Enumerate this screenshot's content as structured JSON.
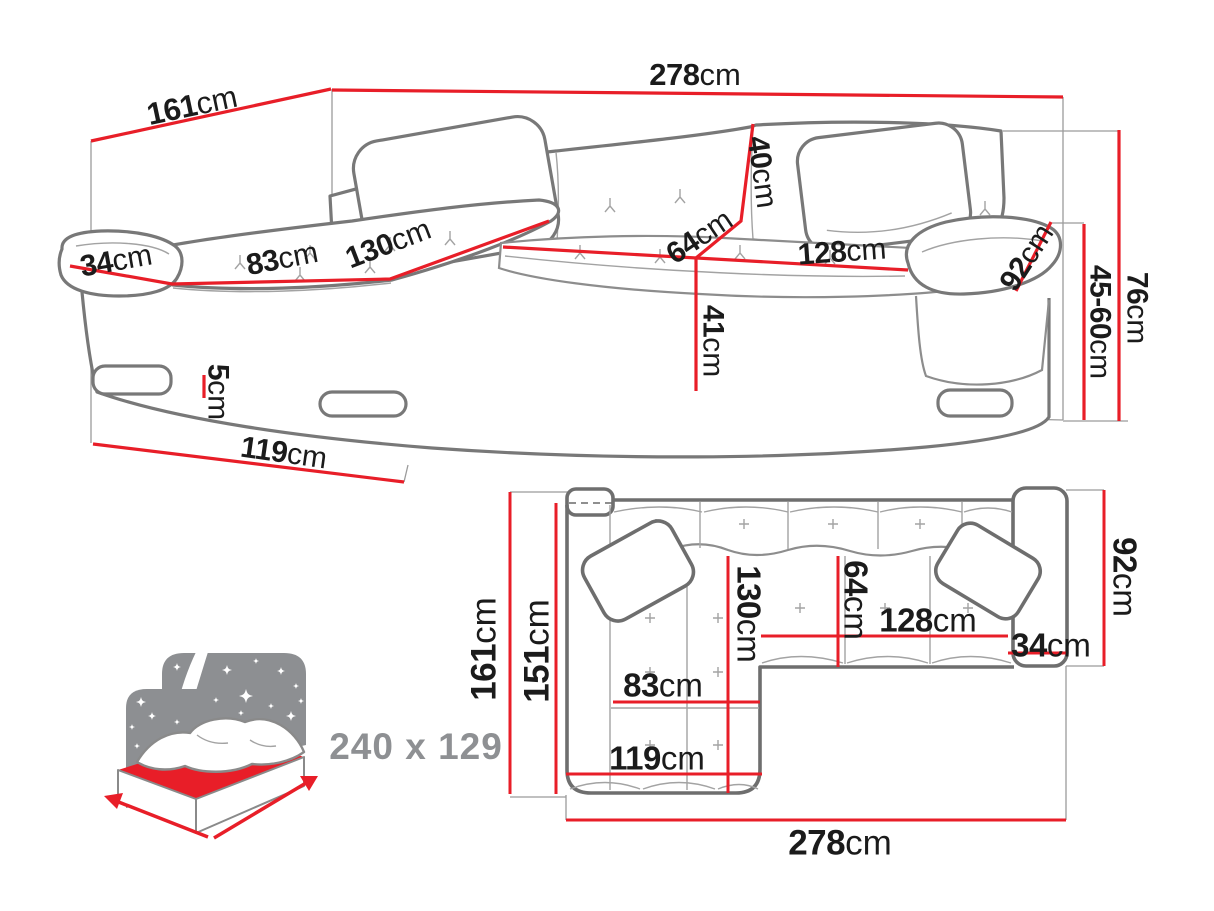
{
  "colors": {
    "dimension_red": "#e81e28",
    "outline_gray": "#787878",
    "detail_gray": "#a3a3a3",
    "label_black": "#1b1b1b",
    "muted_gray": "#8e9093"
  },
  "perspective": {
    "total_width": {
      "value": "278",
      "unit": "cm"
    },
    "total_depth": {
      "value": "161",
      "unit": "cm"
    },
    "armrest_width": {
      "value": "34",
      "unit": "cm"
    },
    "chaise_cushion_width": {
      "value": "83",
      "unit": "cm"
    },
    "chaise_length": {
      "value": "130",
      "unit": "cm"
    },
    "backrest_height": {
      "value": "40",
      "unit": "cm"
    },
    "seat_depth": {
      "value": "64",
      "unit": "cm"
    },
    "seat_width": {
      "value": "128",
      "unit": "cm"
    },
    "armrest_length": {
      "value": "92",
      "unit": "cm"
    },
    "seat_front_height": {
      "value": "41",
      "unit": "cm"
    },
    "leg_height": {
      "value": "5",
      "unit": "cm"
    },
    "chaise_outer_length": {
      "value": "119",
      "unit": "cm"
    },
    "total_height": {
      "value": "76",
      "unit": "cm"
    },
    "seat_height": {
      "value": "45-60",
      "unit": "cm"
    }
  },
  "plan": {
    "total_depth": {
      "value": "161",
      "unit": "cm"
    },
    "inner_depth": {
      "value": "151",
      "unit": "cm"
    },
    "chaise_length": {
      "value": "130",
      "unit": "cm"
    },
    "seat_depth": {
      "value": "64",
      "unit": "cm"
    },
    "seat_width": {
      "value": "128",
      "unit": "cm"
    },
    "armrest_width": {
      "value": "34",
      "unit": "cm"
    },
    "armrest_length": {
      "value": "92",
      "unit": "cm"
    },
    "chaise_cushion_width": {
      "value": "83",
      "unit": "cm"
    },
    "chaise_outer_length": {
      "value": "119",
      "unit": "cm"
    },
    "total_width": {
      "value": "278",
      "unit": "cm"
    }
  },
  "sleeping_function": {
    "label": "240 x 129"
  }
}
